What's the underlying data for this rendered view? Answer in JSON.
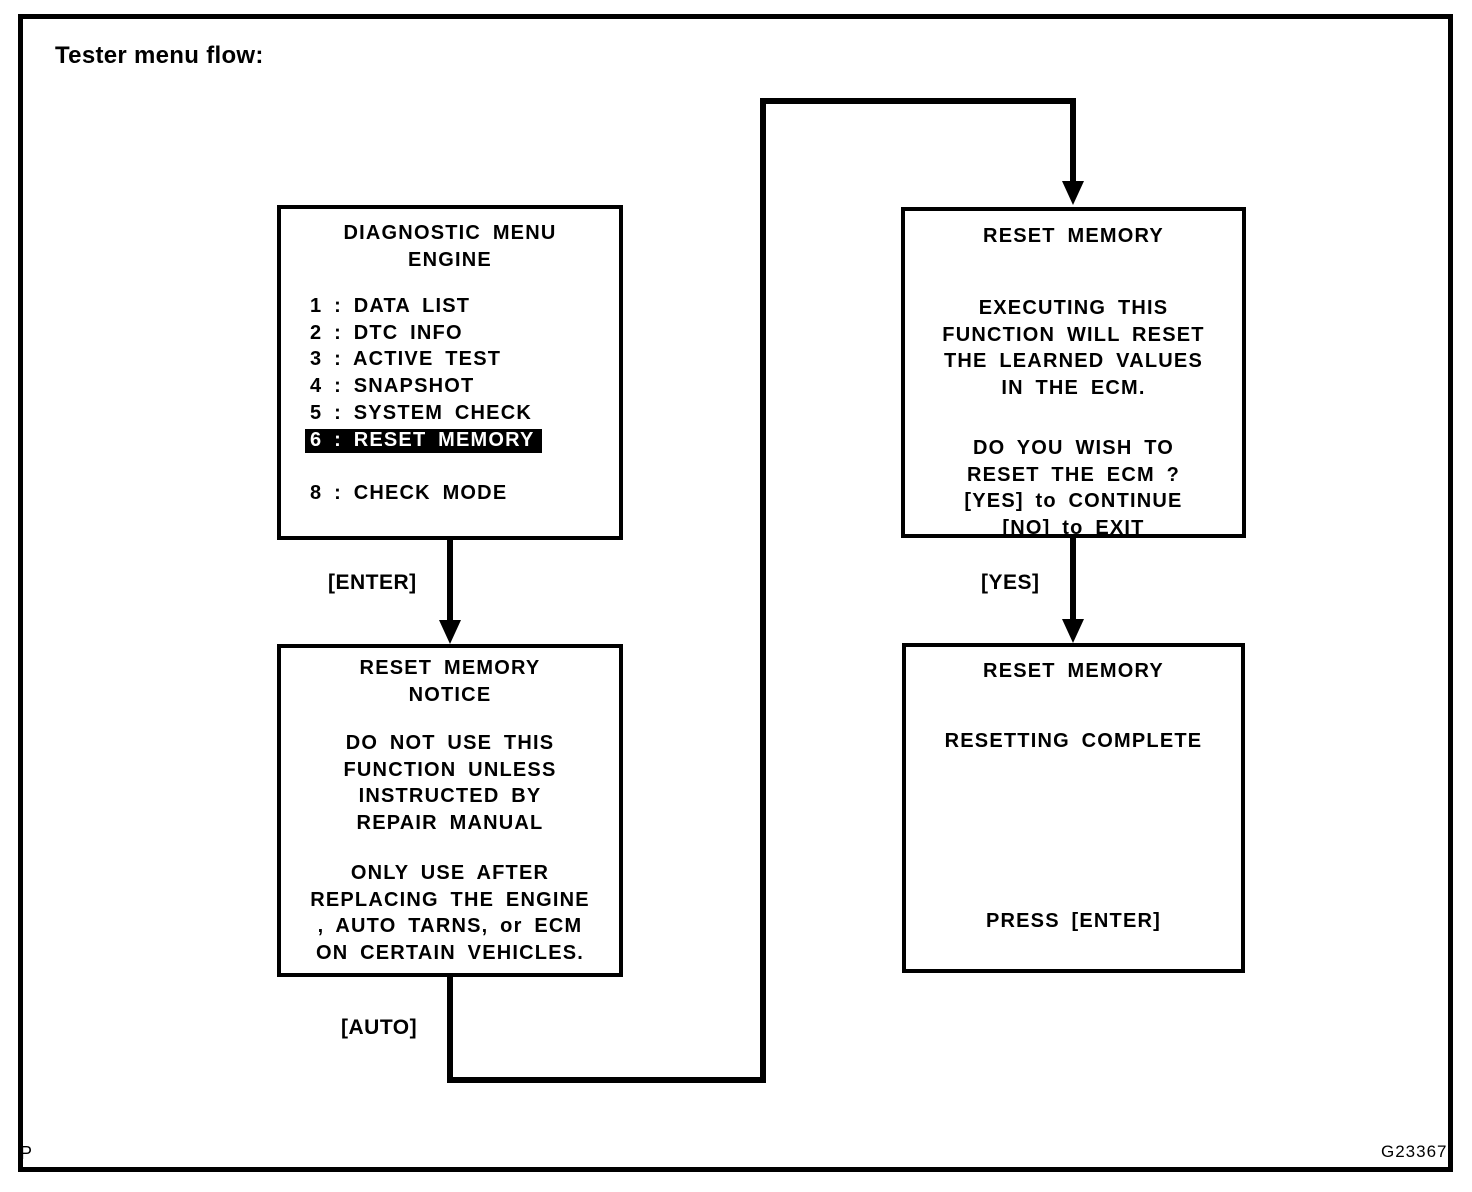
{
  "page": {
    "title": "Tester menu flow:",
    "figure_code": "G23367",
    "page_mark": "P"
  },
  "colors": {
    "ink": "#000000",
    "paper": "#ffffff",
    "highlight_bg": "#000000",
    "highlight_fg": "#ffffff"
  },
  "flow": {
    "labels": {
      "enter": "[ENTER]",
      "yes": "[YES]",
      "auto": "[AUTO]"
    }
  },
  "screens": {
    "diagnostic_menu": {
      "title_line1": "DIAGNOSTIC MENU",
      "title_line2": "ENGINE",
      "items": [
        {
          "label": "1 : DATA LIST",
          "highlighted": false
        },
        {
          "label": "2 : DTC INFO",
          "highlighted": false
        },
        {
          "label": "3 : ACTIVE TEST",
          "highlighted": false
        },
        {
          "label": "4 : SNAPSHOT",
          "highlighted": false
        },
        {
          "label": "5 : SYSTEM CHECK",
          "highlighted": false
        },
        {
          "label": "6 : RESET MEMORY",
          "highlighted": true
        },
        {
          "label": "8 : CHECK MODE",
          "highlighted": false
        }
      ]
    },
    "reset_memory_confirm": {
      "title": "RESET MEMORY",
      "body1": [
        "EXECUTING THIS",
        "FUNCTION WILL RESET",
        "THE LEARNED VALUES",
        "IN THE ECM."
      ],
      "body2": [
        "DO YOU WISH TO",
        "RESET THE ECM ?",
        "[YES] to CONTINUE",
        "[NO] to EXIT"
      ]
    },
    "reset_memory_notice": {
      "title_line1": "RESET MEMORY",
      "title_line2": "NOTICE",
      "body1": [
        "DO NOT USE THIS",
        "FUNCTION UNLESS",
        "INSTRUCTED BY",
        "REPAIR MANUAL"
      ],
      "body2": [
        "ONLY USE AFTER",
        "REPLACING THE ENGINE",
        ", AUTO TARNS, or ECM",
        "ON CERTAIN VEHICLES."
      ]
    },
    "reset_memory_complete": {
      "title": "RESET MEMORY",
      "status": "RESETTING COMPLETE",
      "footer": "PRESS [ENTER]"
    }
  }
}
